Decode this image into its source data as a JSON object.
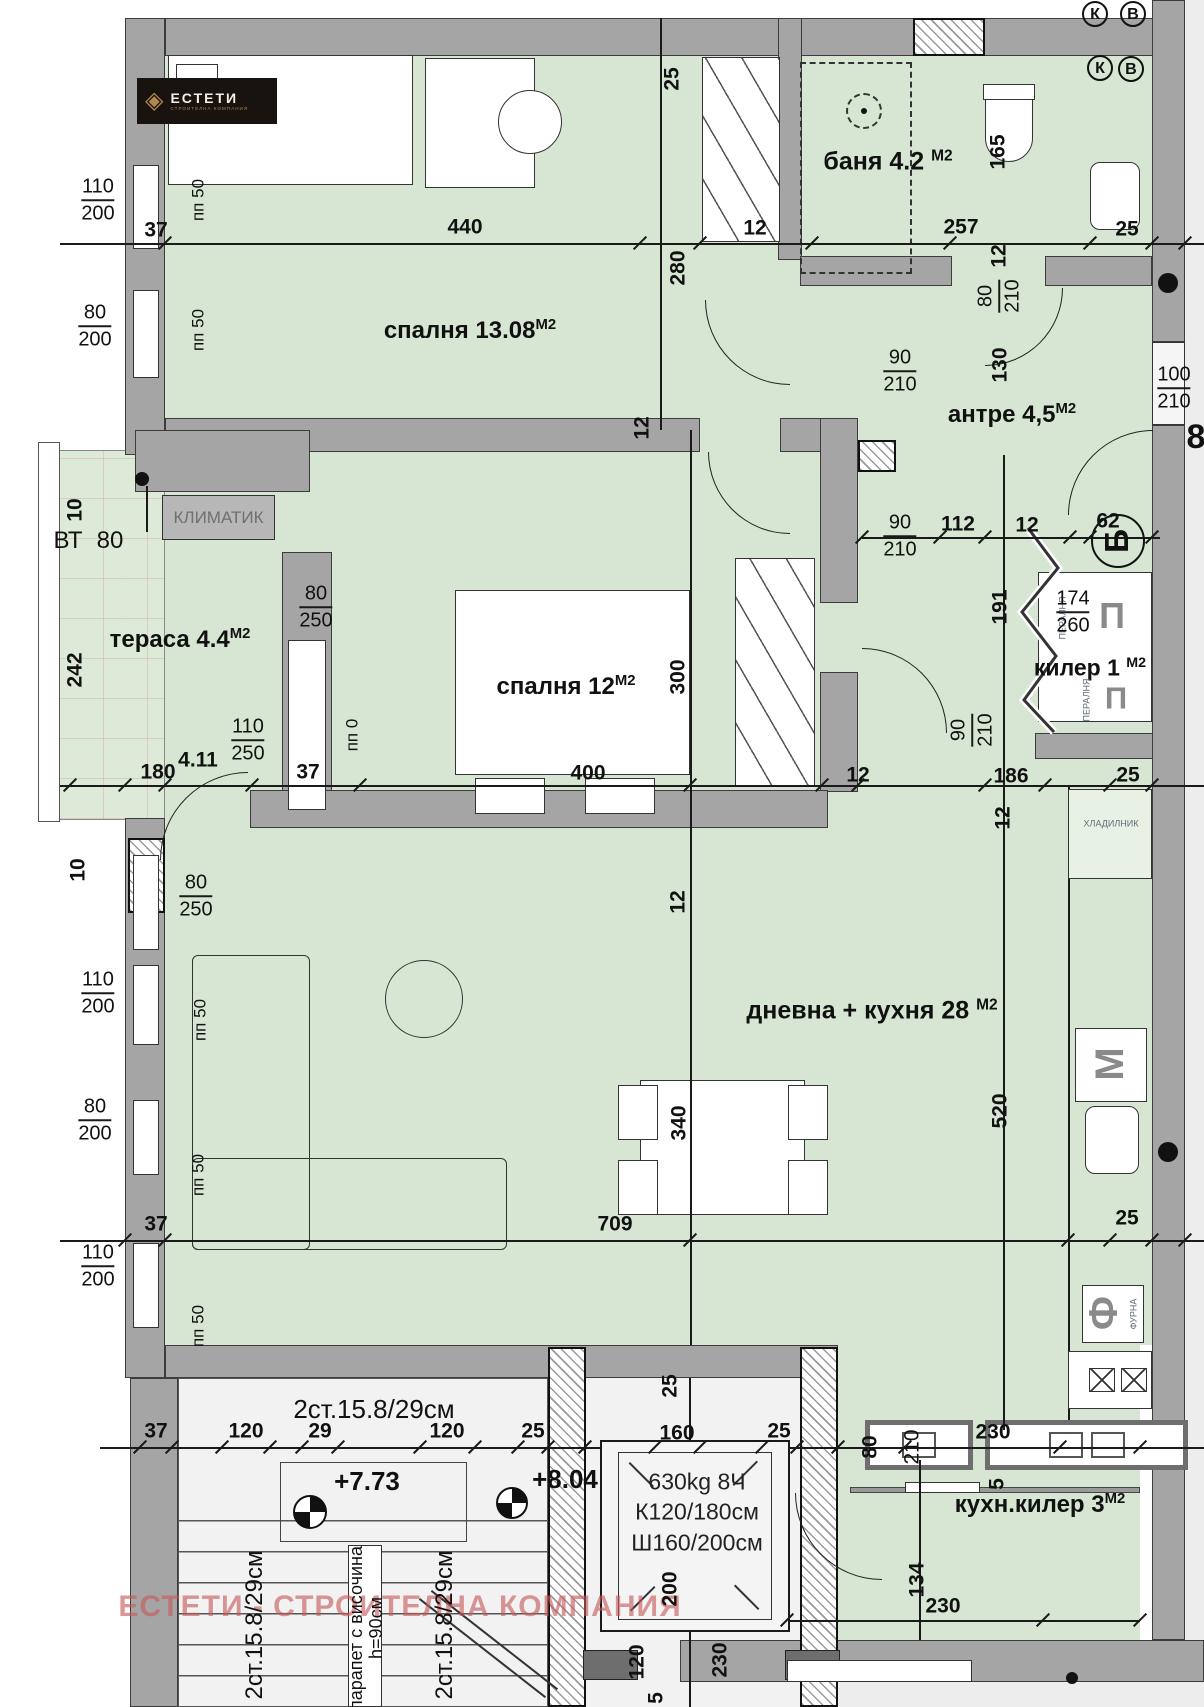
{
  "logo": {
    "icon": "◈",
    "title": "ЕСТЕТИ",
    "subtitle": "СТРОИТЕЛНА КОМПАНИЯ"
  },
  "watermark": "ЕСТЕТИ - СТРОИТЕЛНА КОМПАНИЯ",
  "rooms": {
    "bedroom1": {
      "label": "спалня 13.08",
      "sup": "М2"
    },
    "bath": {
      "label": "баня 4.2 ",
      "sup": "М2"
    },
    "antre": {
      "label": "антре 4,5",
      "sup": "М2"
    },
    "terrace": {
      "label": "тераса 4.4",
      "sup": "М2"
    },
    "bedroom2": {
      "label": "спалня 12",
      "sup": "М2"
    },
    "kiler": {
      "label": "килер 1 ",
      "sup": "М2"
    },
    "living": {
      "label": "дневна + кухня 28 ",
      "sup": "М2"
    },
    "kitchen_kiler": {
      "label": "кухн.килер 3",
      "sup": "М2"
    }
  },
  "elevator": {
    "line1": "630kg 8Ч",
    "line2": "К120/180см",
    "line3": "Ш160/200см"
  },
  "annotations": {
    "klimatik": "КЛИМАТИК"
  },
  "colors": {
    "room_green": "#d7e6d3",
    "wall_gray": "#a5a5a5",
    "watermark_red": "#c65858",
    "logo_gold": "#b3874e"
  },
  "labels": [
    {
      "t": "440",
      "x": 465,
      "y": 227
    },
    {
      "t": "12",
      "x": 755,
      "y": 228
    },
    {
      "t": "257",
      "x": 961,
      "y": 227
    },
    {
      "t": "25",
      "x": 1127,
      "y": 229
    },
    {
      "t": "37",
      "x": 156,
      "y": 230
    },
    {
      "t": "25",
      "x": 672,
      "y": 79,
      "r": -90
    },
    {
      "t": "280",
      "x": 678,
      "y": 268,
      "r": -90
    },
    {
      "t": "165",
      "x": 998,
      "y": 152,
      "r": -90
    },
    {
      "t": "12",
      "x": 999,
      "y": 256,
      "r": -90
    },
    {
      "t": "130",
      "x": 1000,
      "y": 365,
      "r": -90
    },
    {
      "t": "12",
      "x": 642,
      "y": 428,
      "r": -90
    },
    {
      "t": "8",
      "x": 1196,
      "y": 437,
      "s": 34,
      "n": "entrance-number"
    },
    {
      "t": "10",
      "x": 75,
      "y": 510,
      "r": -90
    },
    {
      "t": "ВТ",
      "x": 68,
      "y": 541,
      "s": 24,
      "w": 400,
      "n": "vt-label"
    },
    {
      "t": "80",
      "x": 110,
      "y": 541,
      "s": 24,
      "w": 400
    },
    {
      "t": "242",
      "x": 75,
      "y": 670,
      "r": -90
    },
    {
      "t": "180",
      "x": 158,
      "y": 772
    },
    {
      "t": "4.11",
      "x": 198,
      "y": 760
    },
    {
      "t": "37",
      "x": 308,
      "y": 772
    },
    {
      "t": "400",
      "x": 588,
      "y": 773
    },
    {
      "t": "12",
      "x": 858,
      "y": 775
    },
    {
      "t": "186",
      "x": 1011,
      "y": 776
    },
    {
      "t": "25",
      "x": 1128,
      "y": 775
    },
    {
      "t": "112",
      "x": 958,
      "y": 524
    },
    {
      "t": "12",
      "x": 1027,
      "y": 525
    },
    {
      "t": "62",
      "x": 1108,
      "y": 521
    },
    {
      "t": "191",
      "x": 1000,
      "y": 607,
      "r": -90
    },
    {
      "t": "300",
      "x": 678,
      "y": 677,
      "r": -90
    },
    {
      "t": "12",
      "x": 1003,
      "y": 818,
      "r": -90
    },
    {
      "t": "12",
      "x": 678,
      "y": 902,
      "r": -90
    },
    {
      "t": "340",
      "x": 679,
      "y": 1123,
      "r": -90
    },
    {
      "t": "520",
      "x": 1000,
      "y": 1111,
      "r": -90
    },
    {
      "t": "10",
      "x": 78,
      "y": 870,
      "r": -90
    },
    {
      "t": "37",
      "x": 156,
      "y": 1224
    },
    {
      "t": "709",
      "x": 615,
      "y": 1224
    },
    {
      "t": "25",
      "x": 1127,
      "y": 1218
    },
    {
      "t": "пп 50",
      "x": 198,
      "y": 200,
      "r": -90,
      "s": 17,
      "w": 400
    },
    {
      "t": "пп 50",
      "x": 198,
      "y": 330,
      "r": -90,
      "s": 17,
      "w": 400
    },
    {
      "t": "пп 0",
      "x": 352,
      "y": 735,
      "r": -90,
      "s": 17,
      "w": 400
    },
    {
      "t": "пп 50",
      "x": 200,
      "y": 1020,
      "r": -90,
      "s": 17,
      "w": 400
    },
    {
      "t": "пп 50",
      "x": 198,
      "y": 1175,
      "r": -90,
      "s": 17,
      "w": 400
    },
    {
      "t": "пп 50",
      "x": 198,
      "y": 1326,
      "r": -90,
      "s": 17,
      "w": 400
    },
    {
      "t": "ХЛАДИЛНИК",
      "x": 1111,
      "y": 824,
      "s": 9,
      "w": 400,
      "c": "#5f6d7d",
      "n": "fridge-label"
    },
    {
      "t": "ПЕРАЛНЯ",
      "x": 1063,
      "y": 618,
      "r": -90,
      "s": 9,
      "w": 400,
      "c": "#5f6d7d",
      "n": "washer-label"
    },
    {
      "t": "ПЕРАЛНЯ",
      "x": 1087,
      "y": 700,
      "r": -90,
      "s": 9,
      "w": 400,
      "c": "#5f6d7d",
      "n": "washer-label"
    },
    {
      "t": "П",
      "x": 1112,
      "y": 616,
      "s": 36,
      "c": "#8a8a8a",
      "n": "washer-icon"
    },
    {
      "t": "П",
      "x": 1116,
      "y": 698,
      "s": 31,
      "c": "#8a8a8a",
      "n": "washer-icon"
    },
    {
      "t": "М",
      "x": 1110,
      "y": 1064,
      "r": -90,
      "s": 40,
      "c": "#8a8a8a",
      "n": "dishwasher-icon"
    },
    {
      "t": "Ф",
      "x": 1104,
      "y": 1313,
      "r": -90,
      "s": 40,
      "c": "#8a8a8a",
      "n": "oven-icon"
    },
    {
      "t": "ФУРНА",
      "x": 1134,
      "y": 1314,
      "r": -90,
      "s": 9,
      "w": 400,
      "c": "#5f6d7d",
      "n": "oven-label"
    },
    {
      "t": "230",
      "x": 993,
      "y": 1432
    },
    {
      "t": "80",
      "x": 870,
      "y": 1447,
      "r": -90
    },
    {
      "t": "210",
      "x": 912,
      "y": 1447,
      "r": -90,
      "w": 400
    },
    {
      "t": "5",
      "x": 997,
      "y": 1484,
      "r": -90
    },
    {
      "t": "134",
      "x": 917,
      "y": 1580,
      "r": -90
    },
    {
      "t": "230",
      "x": 943,
      "y": 1606
    },
    {
      "t": "2ст.15.8/29см",
      "x": 374,
      "y": 1409,
      "s": 26,
      "w": 400,
      "n": "stair-label"
    },
    {
      "t": "37",
      "x": 156,
      "y": 1431
    },
    {
      "t": "120",
      "x": 246,
      "y": 1431
    },
    {
      "t": "29",
      "x": 320,
      "y": 1431
    },
    {
      "t": "120",
      "x": 447,
      "y": 1431
    },
    {
      "t": "25",
      "x": 533,
      "y": 1431
    },
    {
      "t": "160",
      "x": 677,
      "y": 1433
    },
    {
      "t": "25",
      "x": 779,
      "y": 1431
    },
    {
      "t": "25",
      "x": 670,
      "y": 1386,
      "r": -90
    },
    {
      "t": "+7.73",
      "x": 367,
      "y": 1481,
      "s": 26,
      "n": "level-mark"
    },
    {
      "t": "+8.04",
      "x": 565,
      "y": 1479,
      "s": 26,
      "n": "level-mark"
    },
    {
      "t": "200",
      "x": 670,
      "y": 1589,
      "r": -90
    },
    {
      "t": "120",
      "x": 637,
      "y": 1662,
      "r": -90
    },
    {
      "t": "230",
      "x": 720,
      "y": 1660,
      "r": -90
    },
    {
      "t": "5",
      "x": 656,
      "y": 1698,
      "r": -90
    },
    {
      "t": "2ст.15.8/29см",
      "x": 255,
      "y": 1625,
      "r": -90,
      "s": 24,
      "w": 400,
      "n": "stair-label"
    },
    {
      "t": "2ст.15.8/29см",
      "x": 445,
      "y": 1625,
      "r": -90,
      "s": 24,
      "w": 400,
      "n": "stair-label"
    },
    {
      "t": "парапет с височина",
      "x": 356,
      "y": 1628,
      "r": -90,
      "s": 18,
      "w": 400,
      "n": "railing-note"
    },
    {
      "t": "h=90см",
      "x": 376,
      "y": 1628,
      "r": -90,
      "s": 18,
      "w": 400,
      "n": "railing-note"
    }
  ],
  "fractions": [
    {
      "top": "110",
      "bottom": "200",
      "x": 98,
      "y": 200
    },
    {
      "top": "80",
      "bottom": "200",
      "x": 95,
      "y": 326
    },
    {
      "top": "80",
      "bottom": "250",
      "x": 316,
      "y": 607
    },
    {
      "top": "110",
      "bottom": "250",
      "x": 248,
      "y": 740
    },
    {
      "top": "80",
      "bottom": "250",
      "x": 196,
      "y": 896
    },
    {
      "top": "110",
      "bottom": "200",
      "x": 98,
      "y": 993
    },
    {
      "top": "80",
      "bottom": "200",
      "x": 95,
      "y": 1120
    },
    {
      "top": "110",
      "bottom": "200",
      "x": 98,
      "y": 1266
    },
    {
      "top": "90",
      "bottom": "210",
      "x": 900,
      "y": 371
    },
    {
      "top": "80",
      "bottom": "210",
      "x": 999,
      "y": 296,
      "r": -90
    },
    {
      "top": "100",
      "bottom": "210",
      "x": 1174,
      "y": 388
    },
    {
      "top": "90",
      "bottom": "210",
      "x": 900,
      "y": 536
    },
    {
      "top": "174",
      "bottom": "260",
      "x": 1073,
      "y": 612
    },
    {
      "top": "90",
      "bottom": "210",
      "x": 972,
      "y": 730,
      "r": -90
    }
  ],
  "markers": [
    {
      "t": "К",
      "x": 1095,
      "y": 14,
      "d": 26
    },
    {
      "t": "В",
      "x": 1133,
      "y": 14,
      "d": 26
    },
    {
      "t": "К",
      "x": 1100,
      "y": 68,
      "d": 26
    },
    {
      "t": "В",
      "x": 1131,
      "y": 69,
      "d": 26
    },
    {
      "t": "Б",
      "x": 1118,
      "y": 541,
      "d": 54,
      "r": -90
    }
  ],
  "ticks": [
    {
      "x": 165,
      "y": 243
    },
    {
      "x": 640,
      "y": 243
    },
    {
      "x": 700,
      "y": 243
    },
    {
      "x": 812,
      "y": 243
    },
    {
      "x": 950,
      "y": 243
    },
    {
      "x": 1090,
      "y": 243
    },
    {
      "x": 1152,
      "y": 243
    },
    {
      "x": 1185,
      "y": 243
    },
    {
      "x": 70,
      "y": 785
    },
    {
      "x": 125,
      "y": 785
    },
    {
      "x": 165,
      "y": 785
    },
    {
      "x": 252,
      "y": 785
    },
    {
      "x": 360,
      "y": 785
    },
    {
      "x": 690,
      "y": 785
    },
    {
      "x": 822,
      "y": 785
    },
    {
      "x": 858,
      "y": 785
    },
    {
      "x": 985,
      "y": 785
    },
    {
      "x": 1045,
      "y": 785
    },
    {
      "x": 1110,
      "y": 785
    },
    {
      "x": 1152,
      "y": 785
    },
    {
      "x": 125,
      "y": 1240
    },
    {
      "x": 165,
      "y": 1240
    },
    {
      "x": 690,
      "y": 1240
    },
    {
      "x": 1068,
      "y": 1240
    },
    {
      "x": 1110,
      "y": 1240
    },
    {
      "x": 1152,
      "y": 1240
    },
    {
      "x": 1185,
      "y": 1240
    },
    {
      "x": 140,
      "y": 1447
    },
    {
      "x": 172,
      "y": 1447
    },
    {
      "x": 222,
      "y": 1447
    },
    {
      "x": 270,
      "y": 1447
    },
    {
      "x": 302,
      "y": 1447
    },
    {
      "x": 338,
      "y": 1447
    },
    {
      "x": 420,
      "y": 1447
    },
    {
      "x": 475,
      "y": 1447
    },
    {
      "x": 518,
      "y": 1447
    },
    {
      "x": 548,
      "y": 1447
    },
    {
      "x": 585,
      "y": 1447
    },
    {
      "x": 655,
      "y": 1447
    },
    {
      "x": 700,
      "y": 1447
    },
    {
      "x": 762,
      "y": 1447
    },
    {
      "x": 797,
      "y": 1447
    },
    {
      "x": 838,
      "y": 1447
    },
    {
      "x": 905,
      "y": 1447
    },
    {
      "x": 1060,
      "y": 1447
    },
    {
      "x": 1140,
      "y": 1447
    },
    {
      "x": 862,
      "y": 537
    },
    {
      "x": 940,
      "y": 537
    },
    {
      "x": 985,
      "y": 537
    },
    {
      "x": 1070,
      "y": 537
    },
    {
      "x": 1090,
      "y": 537
    },
    {
      "x": 1152,
      "y": 537
    },
    {
      "x": 787,
      "y": 1620
    },
    {
      "x": 1043,
      "y": 1620
    },
    {
      "x": 1140,
      "y": 1620
    }
  ],
  "dots": [
    {
      "x": 142,
      "y": 479,
      "d": 14
    },
    {
      "x": 1168,
      "y": 283,
      "d": 20
    },
    {
      "x": 1168,
      "y": 1152,
      "d": 20
    },
    {
      "x": 1072,
      "y": 1678,
      "d": 12
    }
  ]
}
